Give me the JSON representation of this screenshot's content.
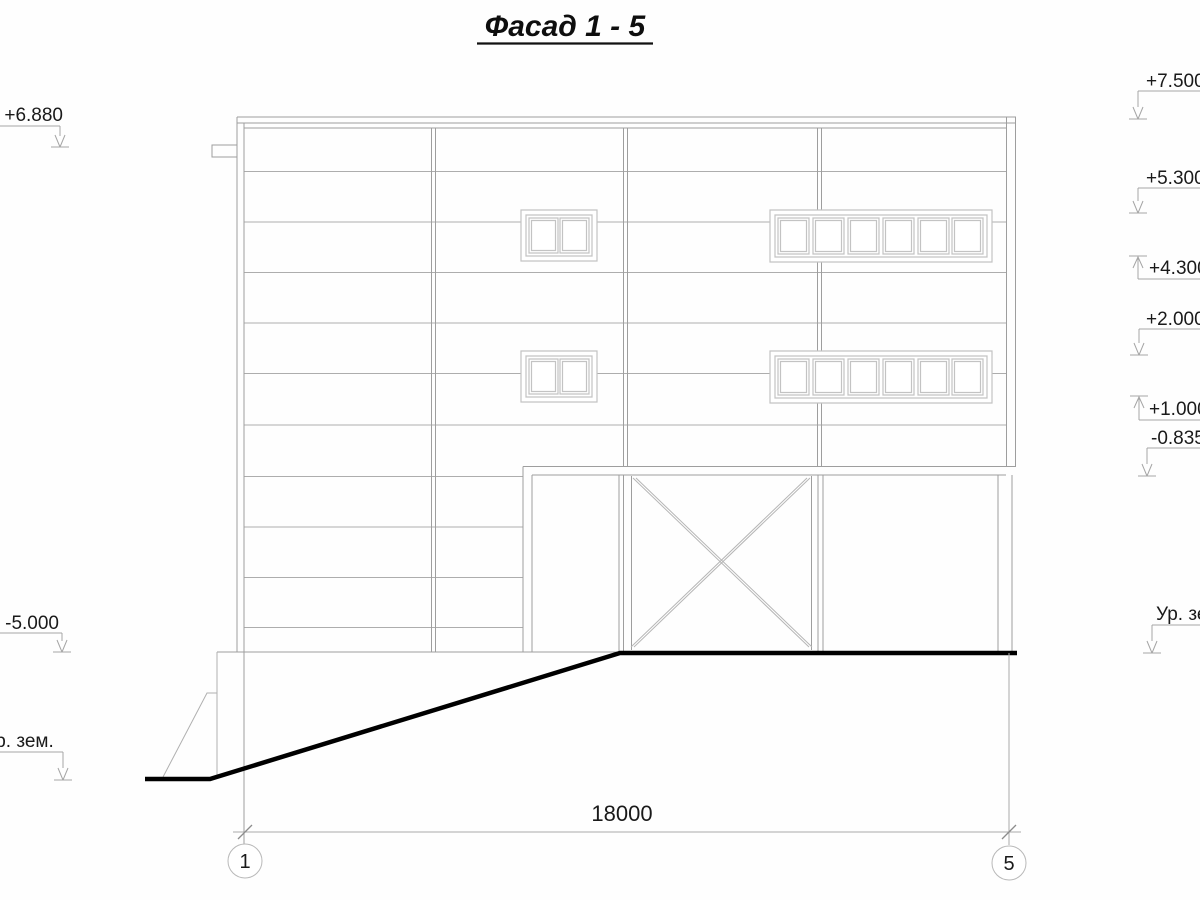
{
  "drawing": {
    "title": "Фасад 1 - 5"
  },
  "elevation_marks": {
    "left": {
      "top": "+6.880",
      "basement": "-5.000",
      "ground": "Ур. зем."
    },
    "right": {
      "roof": "+7.500",
      "level_5300": "+5.300",
      "level_4300": "+4.300",
      "level_2000": "+2.000",
      "level_1000": "+1.000",
      "level_m0835": "-0.835",
      "ground": "Ур. зем."
    }
  },
  "dimension": {
    "length": "18000",
    "axis_left": "1",
    "axis_right": "5"
  }
}
